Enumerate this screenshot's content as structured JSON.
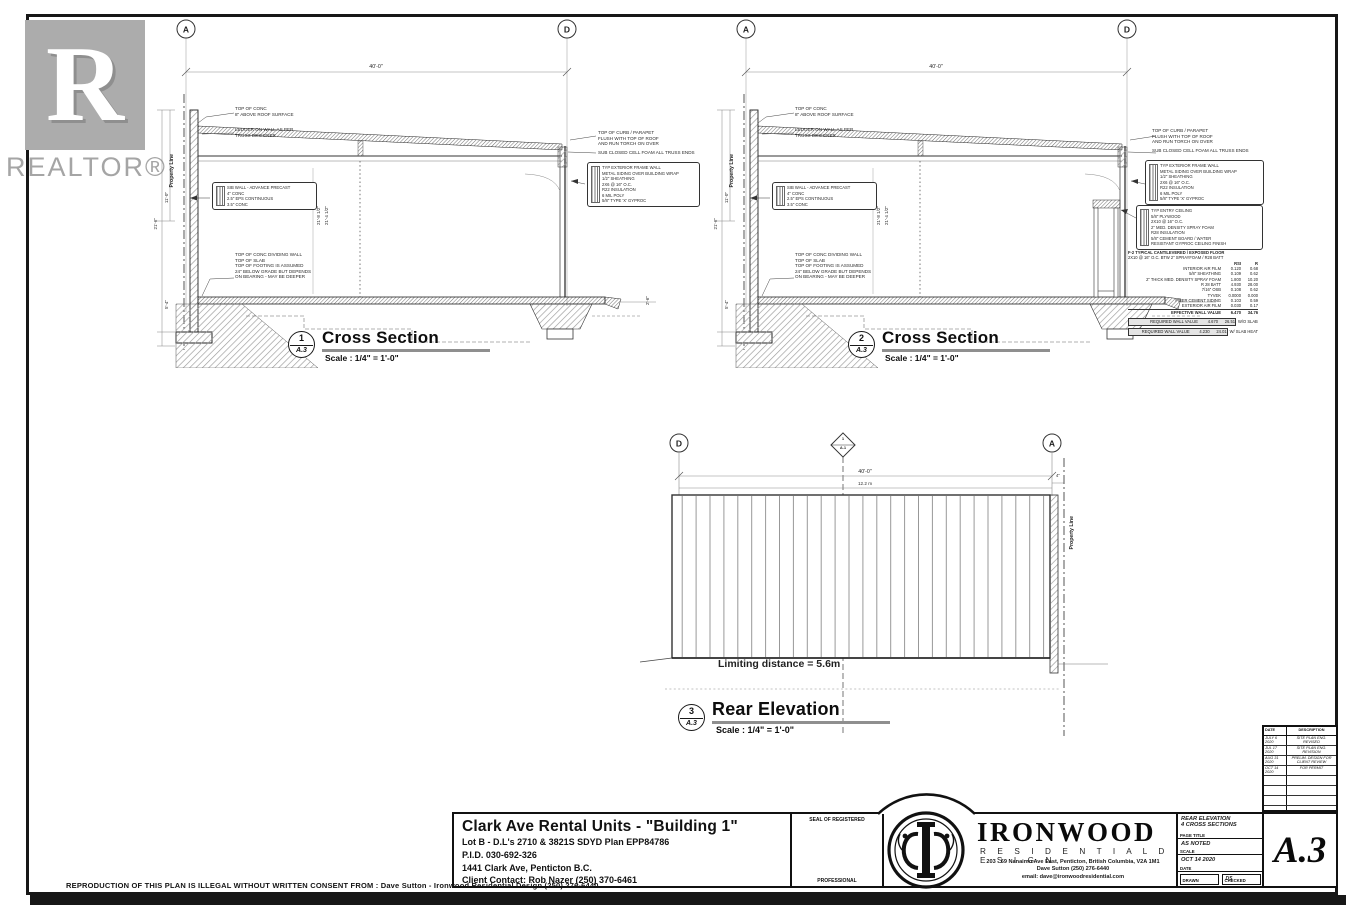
{
  "watermark": {
    "letter": "R",
    "label": "REALTOR®"
  },
  "disclaimer": "REPRODUCTION OF THIS PLAN IS ILLEGAL WITHOUT WRITTEN CONSENT FROM :  Dave Sutton - Ironwood Residential Design (250) 276-6440",
  "cross1": {
    "number": "1",
    "sheet": "A.3",
    "title": "Cross Section",
    "scale": "Scale : 1/4\" = 1'-0\"",
    "grid_left": "A",
    "grid_right": "D",
    "dim_top": "40'-0\"",
    "property_line": "Property Line",
    "note_top_conc": [
      "TOP OF CONC",
      "8\" ABOVE ROOF SURFACE"
    ],
    "note_ledger": [
      "LEDGER ON WALL AS PER",
      "TRUSS DESIGNER"
    ],
    "wall_detail": [
      "SIB WALL - ADVANCE PRECAST",
      "4\" CONC",
      "2.5\" EPS CONTINUOUS",
      "3.5\" CONC"
    ],
    "note_dividing": [
      "TOP OF CONC DIVIDING WALL",
      "TOP OF SLAB",
      "TOP OF FOOTING IS ASSUMED",
      "24\" BELOW GRADE BUT DEPENDS",
      "ON BEARING - MAY BE DEEPER"
    ],
    "dims_mid": [
      "21'-8 1/2\"",
      "21'-4 1/2\""
    ],
    "dims_left": [
      "11'-0\"",
      "21'-6\"",
      "5'-4\""
    ],
    "dim_right": "2'-6\"",
    "note_parapet": [
      "TOP OF CURB / PARAPET",
      "FLUSH WITH TOP OF ROOF",
      "AND RUN TORCH ON OVER"
    ],
    "note_foam": "SUB CLOSED CELL FOAM ALL TRUSS ENDS",
    "wall_box": [
      "TYP EXTERIOR FRAME WALL",
      "METAL SIDING OVER BUILDING WRAP",
      "1/2\" SHEATHING",
      "2X6 @ 16\" O.C.",
      "R22 INSULATION",
      "6 MIL POLY",
      "5/8\" TYPE 'X' GYPROC"
    ]
  },
  "cross2": {
    "number": "2",
    "sheet": "A.3",
    "title": "Cross Section",
    "scale": "Scale : 1/4\" = 1'-0\"",
    "grid_left": "A",
    "grid_right": "D",
    "dim_top": "40'-0\"",
    "property_line": "Property Line",
    "note_top_conc": [
      "TOP OF CONC",
      "8\" ABOVE ROOF SURFACE"
    ],
    "note_ledger": [
      "LEDGER ON WALL AS PER",
      "TRUSS DESIGNER"
    ],
    "wall_detail": [
      "SIB WALL - ADVANCE PRECAST",
      "4\" CONC",
      "2.5\" EPS CONTINUOUS",
      "3.5\" CONC"
    ],
    "note_dividing": [
      "TOP OF CONC DIVIDING WALL",
      "TOP OF SLAB",
      "TOP OF FOOTING IS ASSUMED",
      "24\" BELOW GRADE BUT DEPENDS",
      "ON BEARING - MAY BE DEEPER"
    ],
    "dims_mid": [
      "21'-8 1/2\"",
      "21'-4 1/2\""
    ],
    "dims_left": [
      "11'-0\"",
      "21'-6\"",
      "5'-4\""
    ],
    "note_parapet": [
      "TOP OF CURB / PARAPET",
      "FLUSH WITH TOP OF ROOF",
      "AND RUN TORCH ON OVER"
    ],
    "note_foam": "SUB CLOSED CELL FOAM ALL TRUSS ENDS",
    "wall_box": [
      "TYP EXTERIOR FRAME WALL",
      "METAL SIDING OVER BUILDING WRAP",
      "1/2\" SHEATHING",
      "2X6 @ 16\" O.C.",
      "R22 INSULATION",
      "6 MIL POLY",
      "5/8\" TYPE 'X' GYPROC"
    ],
    "ceiling_box": [
      "TYP ENTRY CEILING",
      "5/8\" PLYWOOD",
      "2X10 @ 16\" O.C.",
      "2\" MED. DENSITY SPRAY FOAM",
      "R28 INSULATION",
      "5/8\" CEMENT BOARD / WATER",
      "RESISTANT GYPROC CEILING FINISH"
    ],
    "floor_table": {
      "title1": "F-2  TYPICAL CANTILEVERED / EXPOSED FLOOR",
      "title2": "2X10 @ 16\" O.C. BTW 2\" SPRAYFOAM / R28 BATT",
      "col_rsi": "RSI",
      "col_r": "R",
      "rows": [
        {
          "name": "INTERIOR AIR FILM",
          "rsi": "0.120",
          "r": "0.68"
        },
        {
          "name": "5/8\" SHEATHING",
          "rsi": "0.109",
          "r": "0.62"
        },
        {
          "name": "2\" THICK MED. DENSITY SPRAY FOAM",
          "rsi": "1.800",
          "r": "10.20"
        },
        {
          "name": "R 28 BATT",
          "rsi": "4.930",
          "r": "28.00"
        },
        {
          "name": "7/16\" OSB",
          "rsi": "0.108",
          "r": "0.62"
        },
        {
          "name": "TYVEK",
          "rsi": "0.0000",
          "r": "0.000"
        },
        {
          "name": "FIBER CEMENT SIDING",
          "rsi": "0.103",
          "r": "0.59"
        },
        {
          "name": "EXTERIOR AIR FILM",
          "rsi": "0.030",
          "r": "0.17"
        }
      ],
      "effective": {
        "name": "EFFECTIVE WALL VALUE",
        "rsi": "6.470",
        "r": "34.76"
      },
      "required": [
        {
          "name": "REQUIRED WALL VALUE",
          "rsi": "4.670",
          "r": "26.51",
          "note": "W/O SLAB"
        },
        {
          "name": "REQUIRED WALL VALUE",
          "rsi": "4.230",
          "r": "24.01",
          "note": "W/ SLAB HEAT"
        }
      ]
    }
  },
  "rear": {
    "number": "3",
    "sheet": "A.3",
    "title": "Rear Elevation",
    "scale": "Scale : 1/4\" = 1'-0\"",
    "grid_left": "D",
    "grid_right": "A",
    "marker_num": "1",
    "marker_sheet": "A.1",
    "dim_top": "40'-0\"",
    "dim_metric": "12.2 m",
    "dim_right": "4\"",
    "property_line": "Property Line",
    "limiting": "Limiting distance  = 5.6m"
  },
  "titleblock": {
    "project": {
      "title": "Clark Ave Rental Units - \"Building 1\"",
      "lines": [
        "Lot B  - D.L's 2710 & 3821S SDYD Plan EPP84786",
        "P.I.D. 030-692-326",
        "1441 Clark Ave, Penticton B.C.",
        "Client Contact: Rob Nazer (250) 370-6461"
      ]
    },
    "seal": {
      "top": "SEAL OF REGISTERED",
      "bottom": "PROFESSIONAL"
    },
    "firm": {
      "name": "IRONWOOD",
      "sub": "R E S I D E N T I A L   D E S I G N",
      "address": "203 - 69 Nanaimo Ave East, Penticton, British Columbia, V2A 1M1",
      "phone": "Dave Sutton  (250) 276-6440",
      "email": "email: dave@ironwoodresidential.com"
    },
    "sheetinfo": {
      "page_title_1": "REAR ELEVATION",
      "page_title_2": "4 CROSS SECTIONS",
      "page_title_label": "PAGE TITLE",
      "scale_value": "AS NOTED",
      "scale_label": "SCALE",
      "date_value": "OCT 14 2020",
      "date_label": "DATE",
      "drawn_value": "",
      "drawn_label": "DRAWN",
      "checked_value": "DS",
      "checked_label": "CHECKED"
    },
    "sheet_number": "A.3"
  },
  "revisions": {
    "header": {
      "date": "DATE",
      "desc": "DESCRIPTION"
    },
    "rows": [
      {
        "date": "JULY 6 2020",
        "desc": "SITE PLAN ENG. REVISED"
      },
      {
        "date": "JUL 17 2020",
        "desc": "SITE PLAN ENG. REVISION"
      },
      {
        "date": "AUG 31 2020",
        "desc": "PRELIM. DESIGN FOR CLIENT REVIEW"
      },
      {
        "date": "OCT 14 2020",
        "desc": "FOR PERMIT"
      },
      {
        "date": "",
        "desc": ""
      },
      {
        "date": "",
        "desc": ""
      },
      {
        "date": "",
        "desc": ""
      },
      {
        "date": "",
        "desc": ""
      }
    ]
  }
}
